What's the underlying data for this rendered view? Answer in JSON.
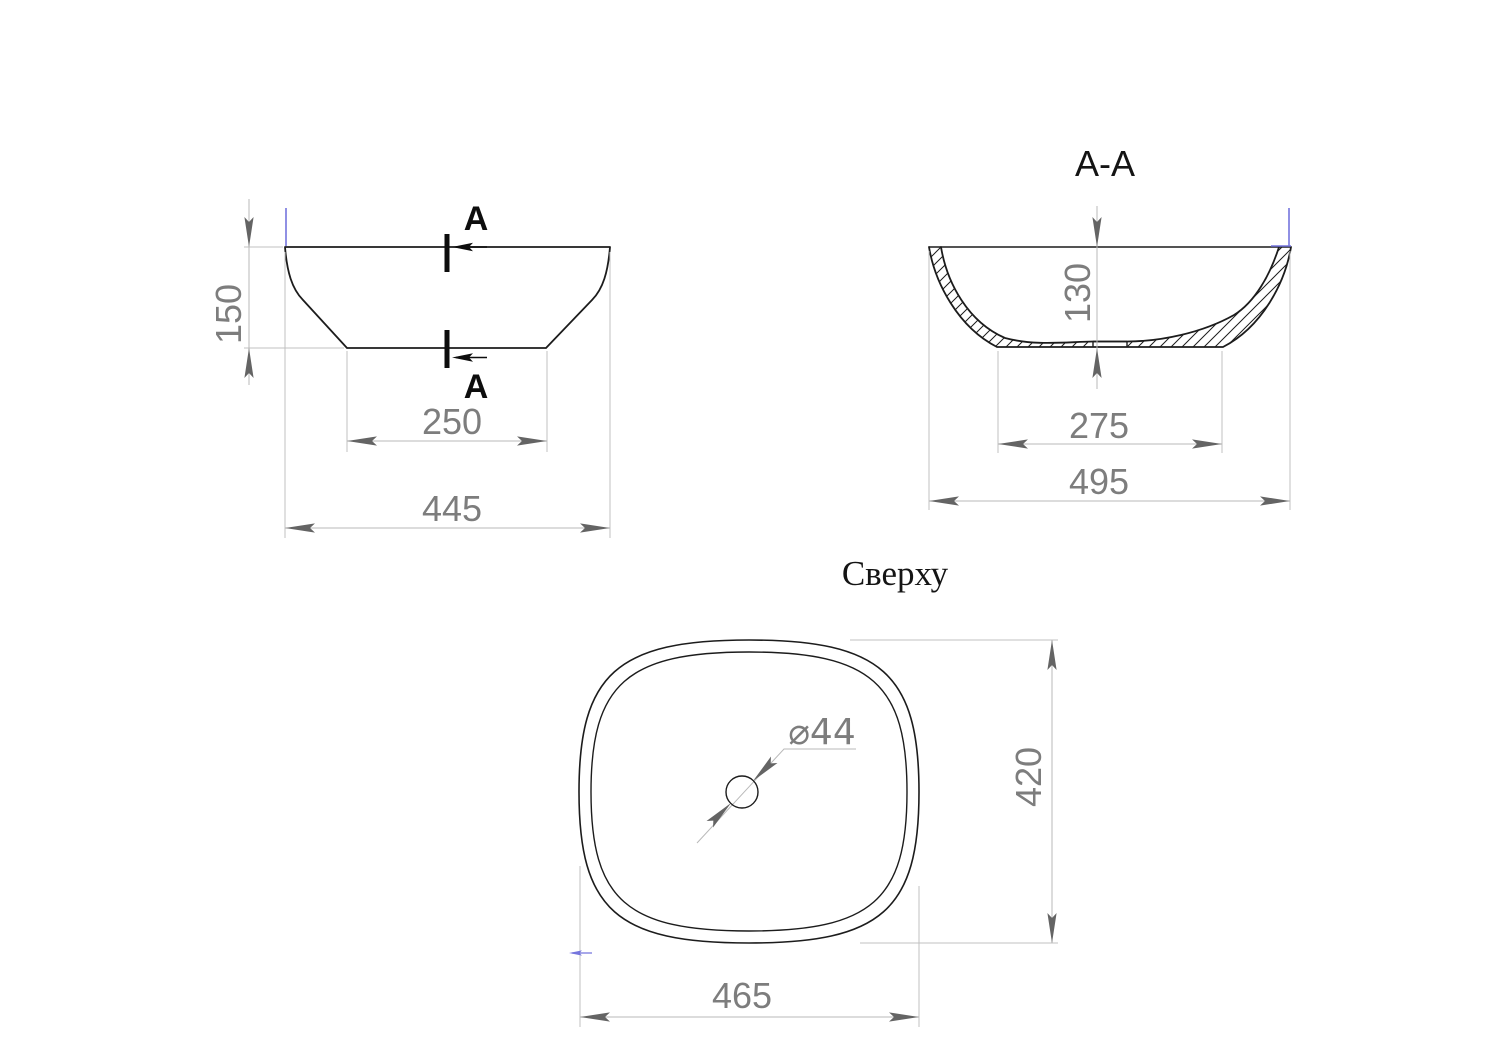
{
  "drawing": {
    "front_view": {
      "section_label": "A",
      "dim_height": "150",
      "dim_bottom_width": "250",
      "dim_top_width": "445"
    },
    "section_view": {
      "title": "A-A",
      "dim_depth": "130",
      "dim_bottom_width": "275",
      "dim_top_width": "495"
    },
    "top_view": {
      "title": "Сверху",
      "dim_width": "465",
      "dim_height": "420",
      "drain_label": "⌀44"
    },
    "colors": {
      "object_line": "#1c1c1c",
      "dimension_line": "#b9b9b9",
      "dimension_text": "#7d7d7d",
      "arrow": "#646464",
      "section_marks": "#0d0d0d",
      "accent_blue": "#7575dd",
      "background": "#ffffff"
    }
  }
}
